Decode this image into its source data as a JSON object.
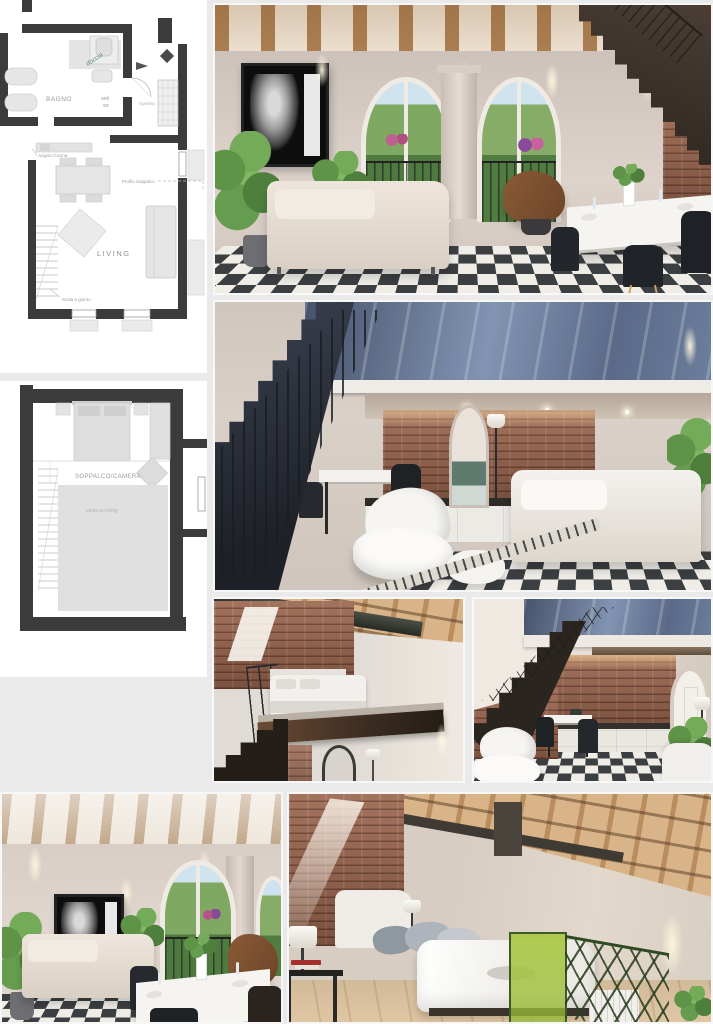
{
  "page": {
    "background": "#eaeaea"
  },
  "palette": {
    "plan_wall": "#3b3b3b",
    "plan_furniture": "#e3e3e3",
    "plan_text": "#9a9a9a",
    "doccia_green": "#5d8a74",
    "checker_dark": "#3c3f42",
    "checker_light": "#f0ede7",
    "brick": "#9c6750",
    "wood": "#c49a6c",
    "wall_beige": "#d6ccc3",
    "stair_dark": "#2e2823",
    "metal_blue": "#5a6a88",
    "accent_lime": "#a8c84e",
    "foliage_green": "#5f9448"
  },
  "plans": {
    "first": {
      "labels": {
        "doccia": "doccia",
        "bagno": "BAGNO",
        "anti": "anti",
        "wc": "wc",
        "ingresso": "ingresso",
        "angolo_cucina": "Angolo Cucina",
        "profilo_soppalco": "Profilo Soppalco",
        "living": "LIVING",
        "scala": "Scala a giorno"
      }
    },
    "mezzanine": {
      "labels": {
        "soppalco_camera": "SOPPALCO/CAMERA",
        "vuoto": "vuoto su living"
      }
    }
  },
  "photos": {
    "items": [
      {
        "name": "living-room-arched-windows"
      },
      {
        "name": "loft-stairs-lounge"
      },
      {
        "name": "mezzanine-bedroom"
      },
      {
        "name": "kitchen-under-stairs"
      },
      {
        "name": "living-room-dining-view"
      },
      {
        "name": "attic-bedroom"
      }
    ]
  }
}
